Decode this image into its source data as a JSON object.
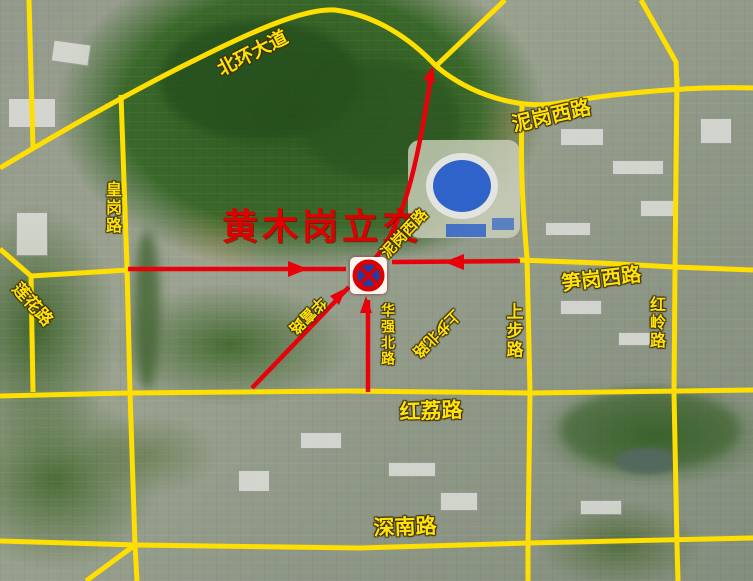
{
  "map": {
    "title": "黄木岗立交",
    "labels": {
      "beihuan": "北环大道",
      "nigang_top": "泥岗西路",
      "huanggang": "皇岗路",
      "lianhua": "莲花路",
      "nigang_diag": "泥岗西路",
      "sungang_west": "笋岗西路",
      "hongling": "红岭路",
      "shangbu": "上步路",
      "huaqiang_north": "华强北路",
      "huafu": "华富路",
      "shangbu_north": "上步北路",
      "hongli": "红荔路",
      "shennan": "深南路"
    },
    "marker": {
      "type": "no-stopping-sign"
    },
    "colors": {
      "road_yellow": "#FFDF00",
      "road_red": "#E8000B",
      "title_red": "#E00000",
      "label_yellow": "#FFE10C",
      "sign_blue": "#1D3FAE"
    }
  }
}
